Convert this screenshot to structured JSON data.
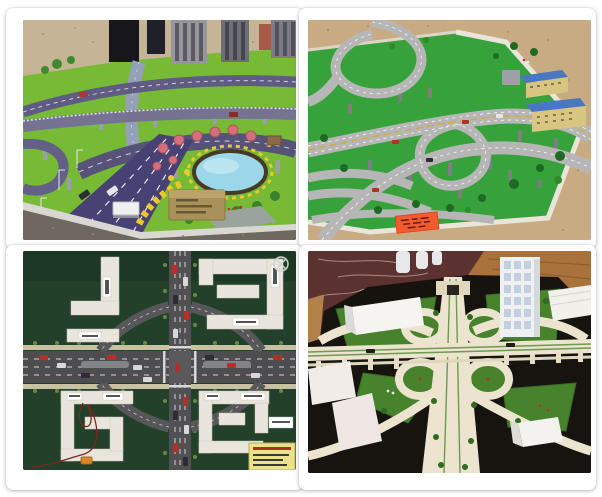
{
  "window": {
    "width_px": 602,
    "height_px": 497,
    "background": "#ffffff"
  },
  "collage": {
    "style": "2x2 white-framed photo grid of traffic scale-model photographs",
    "frame_color": "#ffffff",
    "photos": [
      {
        "name": "city-expressway-model",
        "grid_position": "top-left",
        "alt": "Angled view of a city traffic scale model: purple-blue elevated expressways and a wide avenue with toy cars and streetlights, bright green lawns, pink and yellow trees, a turquoise pond ringed by yellow flower beds, a small brass plaque with three engraved text lines, model skyscrapers and visitors in the background",
        "details": {
          "plaque_text_lines": 3,
          "legible_text": false
        },
        "palette": {
          "road": "#4a4374",
          "grass": "#76ba35",
          "pond": "#9bd7e8",
          "plaque": "#a8925a",
          "floor": "#c5b496",
          "pink_trees": "#d46f7d"
        }
      },
      {
        "name": "highway-interchange-model",
        "grid_position": "top-right",
        "alt": "Scale model of a multi-level freeway interchange: light-gray looping ramps with yellow centre lines on slender piers over a green base with dark trees, yellow apartment blocks with blue roofs at the right, a white stone edge wall, an orange label card on the grass, all on a beige marble floor",
        "details": {
          "label_card_color": "#f25b2d",
          "legible_text": false
        },
        "palette": {
          "road": "#b6b6b6",
          "grass": "#37a13c",
          "roof": "#4a77c4",
          "wall": "#e9e5db",
          "floor": "#c9ab83"
        }
      },
      {
        "name": "crossroads-felt-model",
        "grid_position": "bottom-left",
        "alt": "Top-down teaching model of a four-way crossroads on dark-green felt: grey roads with white lane dashes and toy cars, four curved slip roads around the junction, white C- and L-shaped building outlines with tiny name plates in each quadrant, a red hook-up wire and small orange component at lower left, a yellow specification card at lower right, and a circled X mark at top right",
        "details": {
          "spec_card_color": "#ece287",
          "legible_text": false
        },
        "palette": {
          "felt": "#22402a",
          "road": "#4e4e50",
          "building": "#e9e5dd",
          "card": "#ece287",
          "wire": "#7c2622"
        }
      },
      {
        "name": "cloverleaf-paper-model",
        "grid_position": "bottom-right",
        "alt": "Cream paper model of a cloverleaf interchange on a black baseboard: four loop ramps around crossing elevated roads striped in green, sweeping corner ramps, green felt lawns with miniature trees and figures, white foam buildings including a window-gridded tower, set on dark marble and wooden flooring",
        "details": {
          "legible_text": false
        },
        "palette": {
          "base": "#16130f",
          "structure": "#ece4cf",
          "grass": "#47822d",
          "marble": "#5c3230",
          "wood": "#a9713b"
        }
      }
    ]
  }
}
